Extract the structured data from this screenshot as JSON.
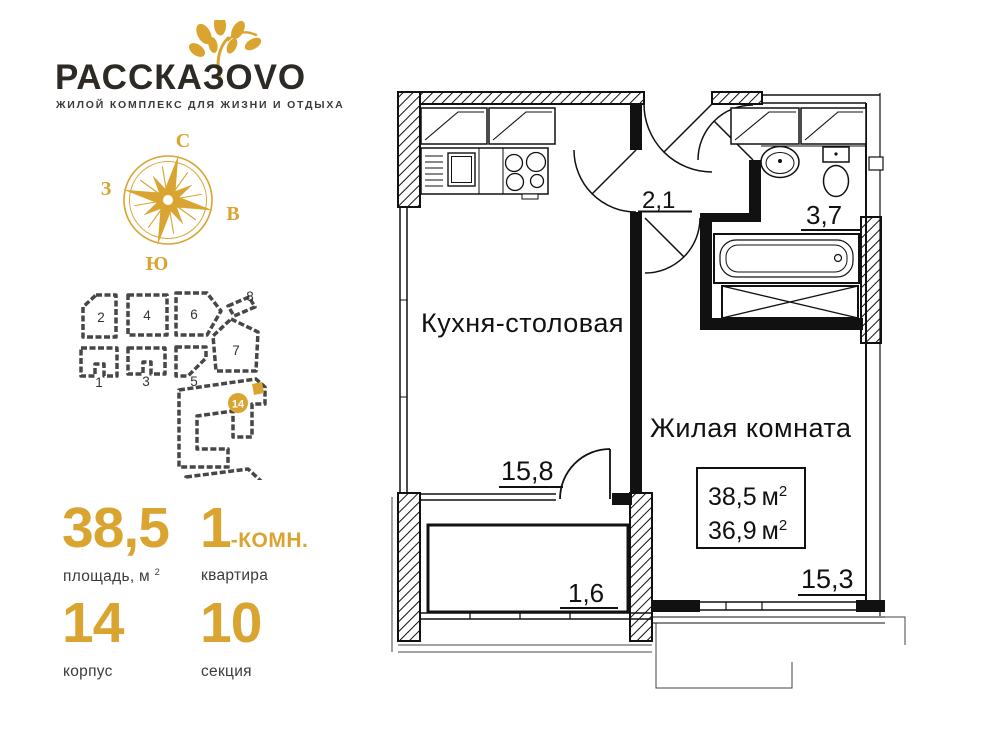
{
  "brand": {
    "title_main": "РАССКАЗО",
    "title_accent": "VO",
    "tagline": "жилой комплекс для жизни и отдыха"
  },
  "compass": {
    "north": "С",
    "east": "В",
    "south": "Ю",
    "west": "З"
  },
  "sitemap": {
    "buildings": [
      "1",
      "2",
      "3",
      "4",
      "5",
      "6",
      "7",
      "8"
    ],
    "marker": "14"
  },
  "stats": {
    "area": {
      "value": "38,5",
      "label_prefix": "площадь, м",
      "label_sup": "2"
    },
    "rooms": {
      "value": "1",
      "suffix": "-КОМН.",
      "label": "квартира"
    },
    "building": {
      "value": "14",
      "label": "корпус"
    },
    "section": {
      "value": "10",
      "label": "секция"
    }
  },
  "plan": {
    "kitchen": {
      "name": "Кухня-столовая",
      "area": "15,8"
    },
    "hall": {
      "area": "2,1"
    },
    "bathroom": {
      "area": "3,7"
    },
    "living": {
      "name": "Жилая комната",
      "area": "15,3"
    },
    "balcony": {
      "area": "1,6"
    },
    "summary": {
      "total": "38,5",
      "total_unit": "м",
      "total_sup": "2",
      "reduced": "36,9",
      "reduced_unit": "м",
      "reduced_sup": "2"
    }
  },
  "colors": {
    "accent": "#d9a430",
    "ink": "#111111",
    "label": "#3b3b3b"
  }
}
